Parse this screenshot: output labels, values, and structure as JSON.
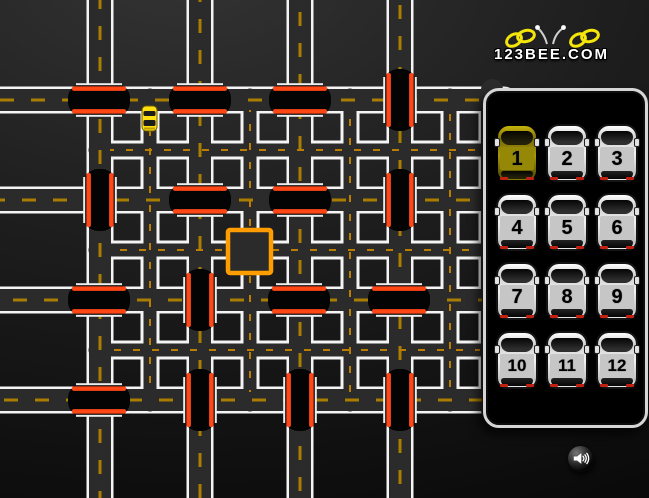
{
  "logo": {
    "text": "123BEE.COM",
    "bee_icon": "bee-icon",
    "wing_color": "#f4e50a"
  },
  "panel": {
    "cars": [
      {
        "label": "1",
        "selected": true
      },
      {
        "label": "2",
        "selected": false
      },
      {
        "label": "3",
        "selected": false
      },
      {
        "label": "4",
        "selected": false
      },
      {
        "label": "5",
        "selected": false
      },
      {
        "label": "6",
        "selected": false
      },
      {
        "label": "7",
        "selected": false
      },
      {
        "label": "8",
        "selected": false
      },
      {
        "label": "9",
        "selected": false
      },
      {
        "label": "10",
        "selected": false
      },
      {
        "label": "11",
        "selected": false
      },
      {
        "label": "12",
        "selected": false
      }
    ]
  },
  "sound": {
    "icon": "speaker-icon"
  },
  "maze": {
    "colors": {
      "road": "#2b2b2b",
      "edge": "#f4f4f4",
      "dash_main": "#a87d00",
      "dash_alley": "#bc7d00",
      "barrier_body": "#040404",
      "barrier_stripe": "#ff4716",
      "barrier_edge": "#eeeeee",
      "target": "#ff9d00",
      "player_car": "#ffdf12"
    },
    "main_roads": {
      "h_y": [
        100,
        200,
        300,
        400
      ],
      "v_x": [
        100,
        200,
        300,
        400
      ],
      "hidden_v_x": 492
    },
    "alleys": {
      "h_y": [
        150,
        250,
        350
      ],
      "v_x": [
        150,
        250,
        350,
        450
      ]
    },
    "barriers": [
      {
        "x": 99,
        "y": 100,
        "o": "h"
      },
      {
        "x": 200,
        "y": 100,
        "o": "h"
      },
      {
        "x": 300,
        "y": 100,
        "o": "h"
      },
      {
        "x": 400,
        "y": 100,
        "o": "v"
      },
      {
        "x": 100,
        "y": 200,
        "o": "v"
      },
      {
        "x": 200,
        "y": 200,
        "o": "h"
      },
      {
        "x": 300,
        "y": 200,
        "o": "h"
      },
      {
        "x": 400,
        "y": 200,
        "o": "v"
      },
      {
        "x": 99,
        "y": 300,
        "o": "h"
      },
      {
        "x": 200,
        "y": 300,
        "o": "v"
      },
      {
        "x": 299,
        "y": 300,
        "o": "h"
      },
      {
        "x": 399,
        "y": 300,
        "o": "h"
      },
      {
        "x": 99,
        "y": 400,
        "o": "h"
      },
      {
        "x": 200,
        "y": 400,
        "o": "v"
      },
      {
        "x": 300,
        "y": 400,
        "o": "v"
      },
      {
        "x": 400,
        "y": 400,
        "o": "v"
      }
    ],
    "target": {
      "x": 228,
      "y": 230,
      "size": 43
    },
    "player_car": {
      "x": 142,
      "y": 106,
      "w": 15,
      "h": 25,
      "heading": "down"
    }
  }
}
